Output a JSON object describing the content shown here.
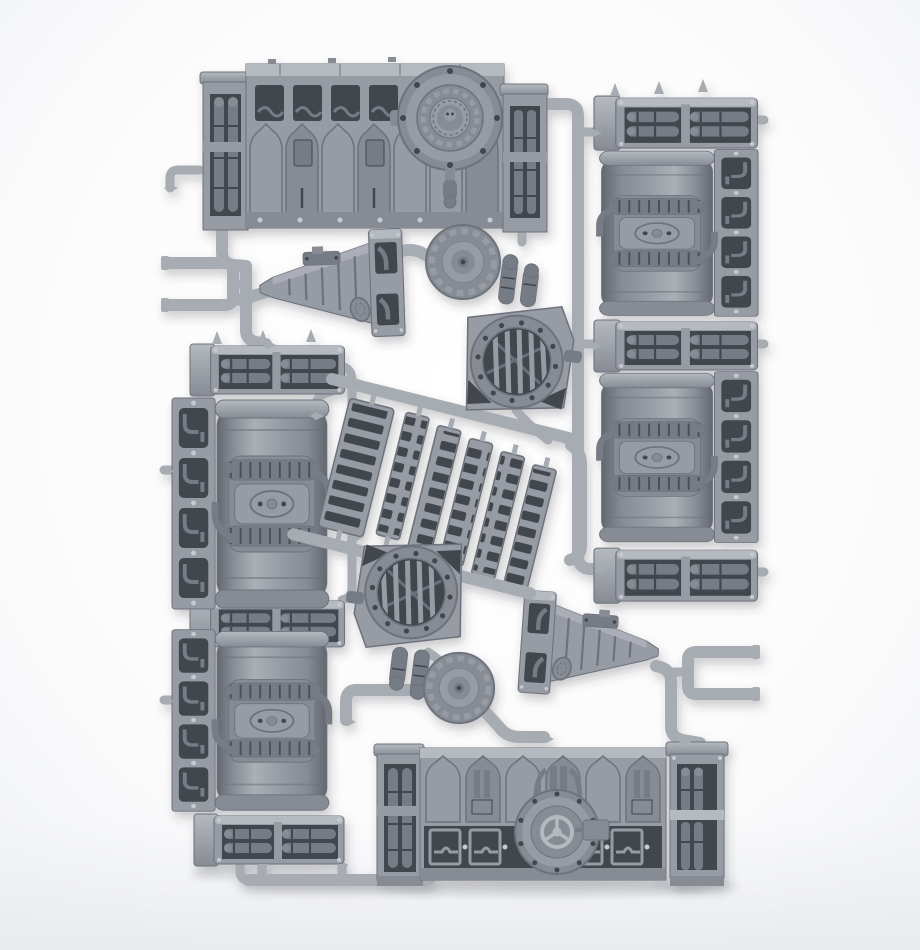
{
  "image": {
    "type": "product-photo",
    "subject": "grey plastic injection-moulded model sprue with industrial gothic terrain parts",
    "background": "white studio backdrop with soft shadows",
    "description": "Plastic model kit sprue frame in neutral grey containing: two long wall sections with circular cog hatches, three horizontal barrel tank assemblies with central pump blocks, six pipe-crate sections, two circular grille vent housings with pipe stubs, six ribbed walkway treads on runner rails, two toothed cog hub discs, two ribbed buttress wedges with oval cog emblems, pipe pillar columns and U-shaped runner handles, all joined by light grey sprue runners with moulding gates."
  },
  "parts": {
    "wall_top": "wall section with round cog-emblem hatch",
    "wall_bottom": "wall section with valve-wheel hatch",
    "tank_count": 3,
    "pipe_crate_count": 6,
    "vent_count": 2,
    "tread_count": 6,
    "disc_count": 2,
    "wedge_count": 2,
    "handle_count": 2
  },
  "palette": {
    "bg": "#ffffff",
    "bgEdge": "#edeff2",
    "runner": "#a7abb2",
    "part": "#979ba3",
    "partLight": "#b5b9c0",
    "partMid": "#878b93",
    "recess": "#555960",
    "deep": "#42464d",
    "pipe": "#767b85",
    "edge": "#6e727b",
    "rivet": "#c7cad0",
    "tankHi": "#abafb6",
    "tankLo": "#63676f",
    "shadow": "#394048"
  }
}
